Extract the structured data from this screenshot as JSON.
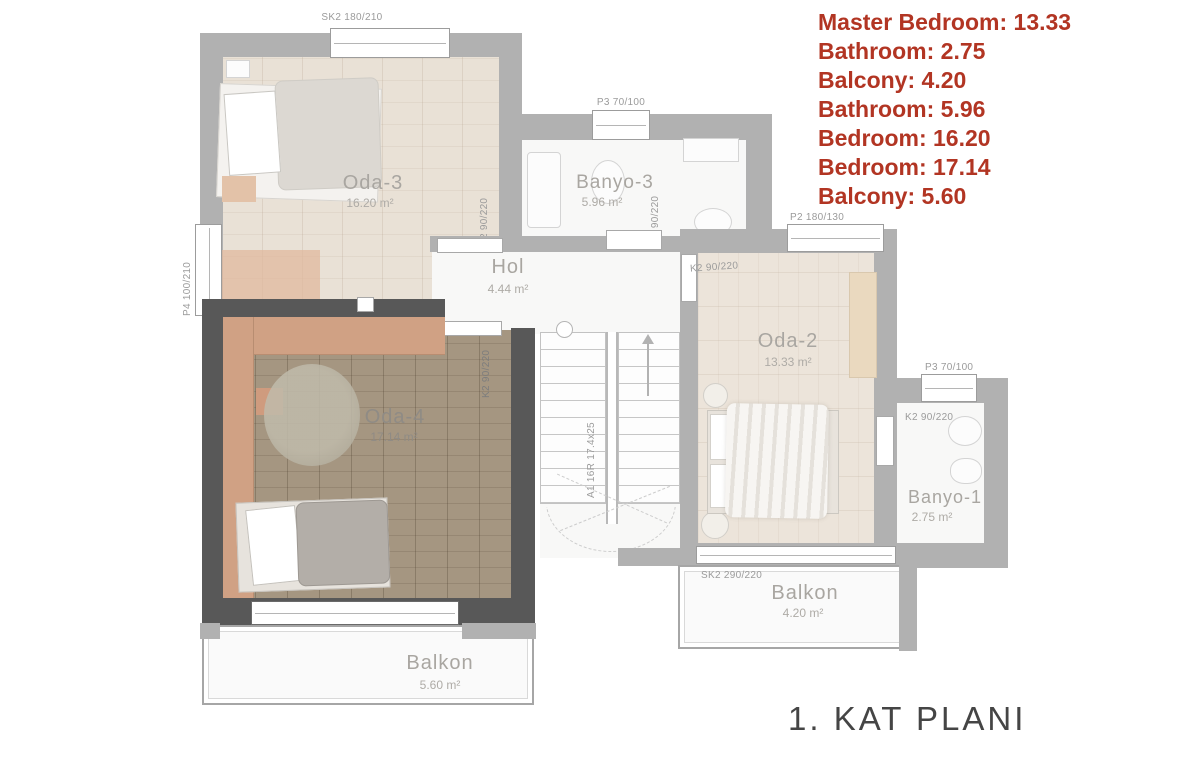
{
  "legend": {
    "color": "#b23523",
    "items": [
      "Master Bedroom: 13.33",
      "Bathroom: 2.75",
      "Balcony: 4.20",
      "Bathroom: 5.96",
      "Bedroom: 16.20",
      "Bedroom: 17.14",
      "Balcony: 5.60"
    ]
  },
  "title": "1. KAT PLANI",
  "rooms": {
    "oda3": {
      "name": "Oda-3",
      "area": "16.20 m²"
    },
    "banyo3": {
      "name": "Banyo-3",
      "area": "5.96 m²"
    },
    "hol": {
      "name": "Hol",
      "area": "4.44 m²"
    },
    "oda2": {
      "name": "Oda-2",
      "area": "13.33 m²"
    },
    "banyo1": {
      "name": "Banyo-1",
      "area": "2.75 m²"
    },
    "oda4": {
      "name": "Oda-4",
      "area": "17.14 m²"
    },
    "balkon_left": {
      "name": "Balkon",
      "area": "5.60 m²"
    },
    "balkon_right": {
      "name": "Balkon",
      "area": "4.20 m²"
    }
  },
  "codes": {
    "sk2_180_210": "SK2 180/210",
    "p4_100_210": "P4 100/210",
    "p3_70_100": "P3 70/100",
    "p2_180_130": "P2 180/130",
    "k2_90_220": "K2 90/220",
    "sk2_290_220": "SK2 290/220",
    "sk1_300_220": "SK1 300/220",
    "stair": "A1 16R 17.4x25"
  },
  "highlight": {
    "wall_color": "#585858",
    "wardrobe_color": "#d0a184"
  }
}
